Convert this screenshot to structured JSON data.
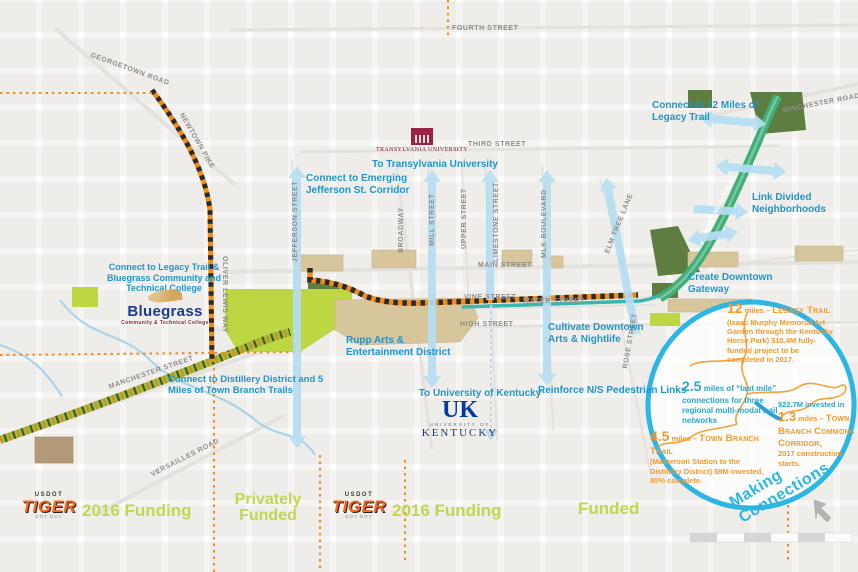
{
  "colors": {
    "annotation_blue": "#2095cc",
    "circle_outline_blue": "#2db5e4",
    "stat_orange": "#f29a2e",
    "stat_teal": "#2aa7cb",
    "funding_green": "#c3d651",
    "trail_green": "#3fae7b",
    "trail_band_green": "#8fc63f",
    "hatch_orange": "#ef8c1e",
    "arrow_light_blue": "#b5def2"
  },
  "streets": {
    "georgetown": "GEORGETOWN ROAD",
    "newtown": "NEWTOWN PIKE",
    "fourth": "FOURTH STREET",
    "third": "THIRD STREET",
    "winchester": "WINCHESTER ROAD",
    "jefferson": "JEFFERSON STREET",
    "broadway": "BROADWAY",
    "mill": "MILL STREET",
    "upper": "UPPER STREET",
    "limestone": "LIMESTONE STREET",
    "mlk": "MLK BOULEVARD",
    "main": "MAIN STREET",
    "vine": "VINE STREET",
    "water": "WATER STREET",
    "high": "HIGH STREET",
    "rose": "ROSE STREET",
    "elm_tree": "ELM TREE LANE",
    "oliver_lewis": "OLIVER LEWIS WAY",
    "manchester": "MANCHESTER STREET",
    "versailles": "VERSAILLES ROAD",
    "midland": "MIDLAND AVENUE"
  },
  "annotations": {
    "jefferson_corridor": "Connect to Emerging Jefferson St. Corridor",
    "transylvania": "To Transylvania University",
    "legacy_12": "Connect to 12 Miles of Legacy Trail",
    "link_neighborhoods": "Link Divided Neighborhoods",
    "legacy_bluegrass": "Connect to Legacy Trail & Bluegrass Community and Technical College",
    "gateway": "Create Downtown Gateway",
    "arts_nightlife": "Cultivate Downtown Arts & Nightlife",
    "rupp": "Rupp Arts & Entertainment District",
    "distillery": "Connect to Distillery District and 5 Miles of Town Branch Trails",
    "uk": "To University of Kentucky",
    "ped_links": "Reinforce N/S Pedestrian Links"
  },
  "logos": {
    "transylvania_name": "TRANSYLVANIA UNIVERSITY",
    "bluegrass_name": "Bluegrass",
    "bluegrass_sub": "Community & Technical College",
    "uk_top": "UK",
    "uk_mid": "UNIVERSITY OF",
    "uk_bottom": "KENTUCKY",
    "tiger_top": "USDOT",
    "tiger_name": "TIGER",
    "tiger_sub": "DOT.GOV"
  },
  "funding": {
    "f2016_left": "2016 Funding",
    "privately": "Privately Funded",
    "f2016_mid": "2016 Funding",
    "funded": "Funded"
  },
  "circle": {
    "legacy": {
      "num": "12",
      "prefix": "miles – ",
      "name": "Legacy Trail",
      "detail": "(Isaac Murphy Memorial Art Garden through the Kentucky Horse Park) $10.4M fully-funded project to be completed in 2017."
    },
    "last_mile": {
      "num": "2.5",
      "text": "miles of “last mile” connections for three regional multi-modal trail networks"
    },
    "invested_line": "$22.7M invested in",
    "commons": {
      "num": "1.3",
      "prefix": "miles – ",
      "name": "Town Branch Commons Corridor,",
      "detail": "2017 construction starts."
    },
    "town_branch": {
      "num": "4.5",
      "prefix": "miles – ",
      "name": "Town Branch Trail",
      "detail": "(Masterson Station to the Distillery District) $9M invested, 80% complete."
    },
    "making_connections": "Making Connections"
  }
}
